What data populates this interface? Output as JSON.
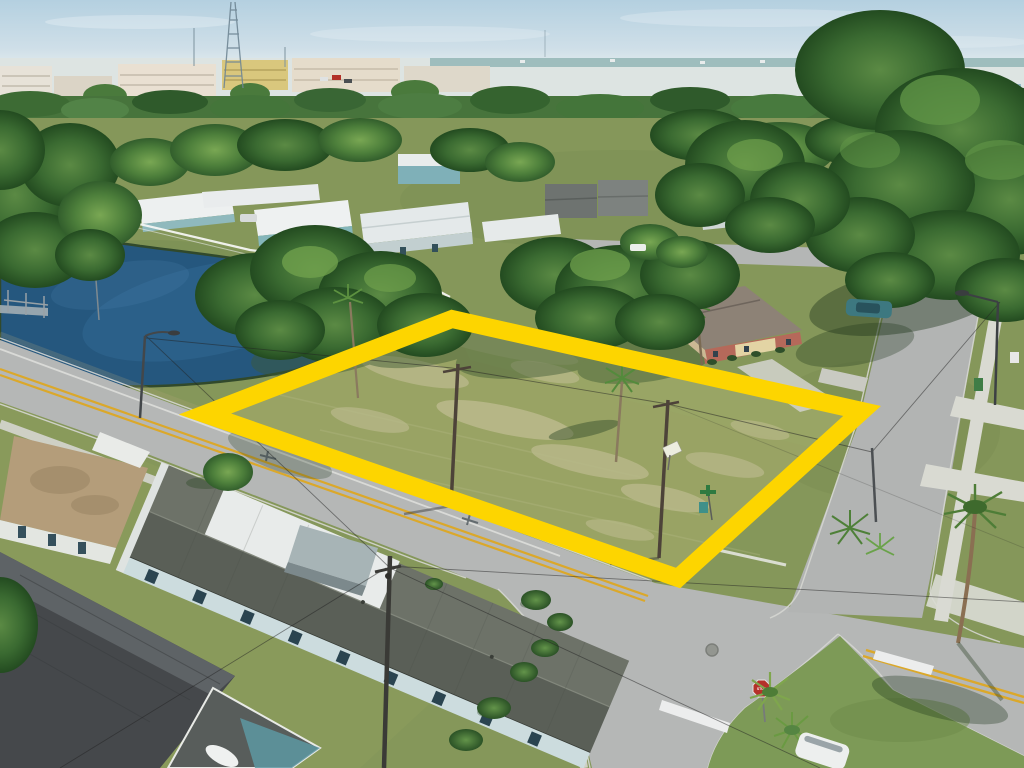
{
  "scene": {
    "type": "aerial-drone-real-estate-photo",
    "subject": "vacant corner lot outlined with a yellow boundary overlay at a suburban intersection with a pond",
    "stop_sign": {
      "label": "STOP",
      "color": "#b5312a"
    },
    "boundary": {
      "color": "#fdd500",
      "stroke_width": 18,
      "vertices": [
        [
          452,
          319
        ],
        [
          205,
          414
        ],
        [
          678,
          578
        ],
        [
          862,
          411
        ]
      ]
    },
    "palette": {
      "sky": "#bdd6e3",
      "distant_water": "#8fb3b4",
      "pond": "#265a82",
      "grass": "#85975a",
      "lot_grass": "#99a364",
      "sand": "#cdc6a2",
      "road": "#b5b7b6",
      "concrete": "#d9dad2",
      "tree_dark": "#2f5a2a",
      "tree_light": "#6aa24a",
      "roof_dark": "#53575a",
      "roof_white": "#e8ebea",
      "roof_tan": "#b49d7a",
      "brick": "#b5695a",
      "curb": "#d6d7d2",
      "lane_yellow": "#dba82a"
    },
    "objects": [
      "sky",
      "clouds",
      "radio-tower",
      "antennas",
      "distant-city",
      "distant-water",
      "tree-line",
      "pond",
      "pond-pier",
      "mobile-home-park",
      "white-fence",
      "vacant-lot",
      "yellow-boundary",
      "oak-canopy",
      "palm-trees",
      "utility-poles",
      "power-lines",
      "main-road",
      "cross-street",
      "side-street",
      "intersection",
      "double-yellow-line",
      "white-edge-line",
      "crosswalk-markings",
      "stop-bar",
      "stop-sign",
      "street-lights",
      "sidewalk",
      "driveways",
      "curb-ramp",
      "hedges",
      "round-tree",
      "tan-roof-building",
      "long-white-roof-house",
      "dark-roof-house",
      "carport",
      "brick-house",
      "trash-bins",
      "parked-cars",
      "white-van",
      "manhole-cover",
      "grass-island",
      "bird-shadow"
    ]
  }
}
